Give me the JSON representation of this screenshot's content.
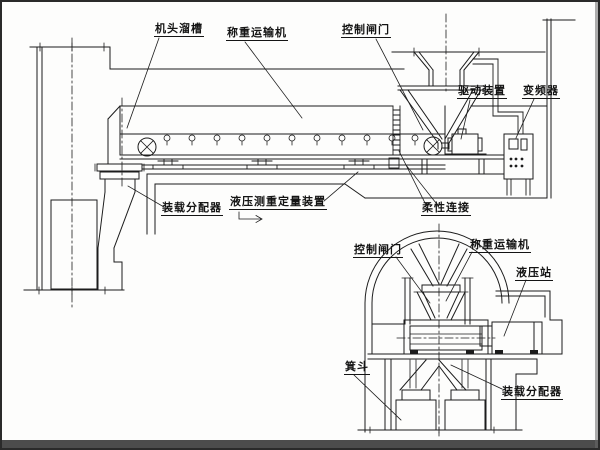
{
  "diagram": {
    "type": "engineering-schematic",
    "description": "Skip loading system with hydraulic weighing conveyor — plan/section schematic",
    "colors": {
      "background": "#fdfdfc",
      "line": "#1c1c1c",
      "border": "#2a2a2a"
    },
    "main_view": {
      "labels": {
        "head_chute": "机头溜槽",
        "weighing_conveyor": "称重运输机",
        "control_gate": "控制闸门",
        "drive_unit": "驱动装置",
        "frequency_converter": "变频器",
        "loading_distributor": "装载分配器",
        "hydraulic_weighing_device": "液压测重定量装置",
        "flexible_connection": "柔性连接"
      }
    },
    "detail_view": {
      "labels": {
        "control_gate": "控制闸门",
        "weighing_conveyor": "称重运输机",
        "hydraulic_station": "液压站",
        "skip_bucket": "箕斗",
        "loading_distributor": "装载分配器"
      }
    }
  }
}
